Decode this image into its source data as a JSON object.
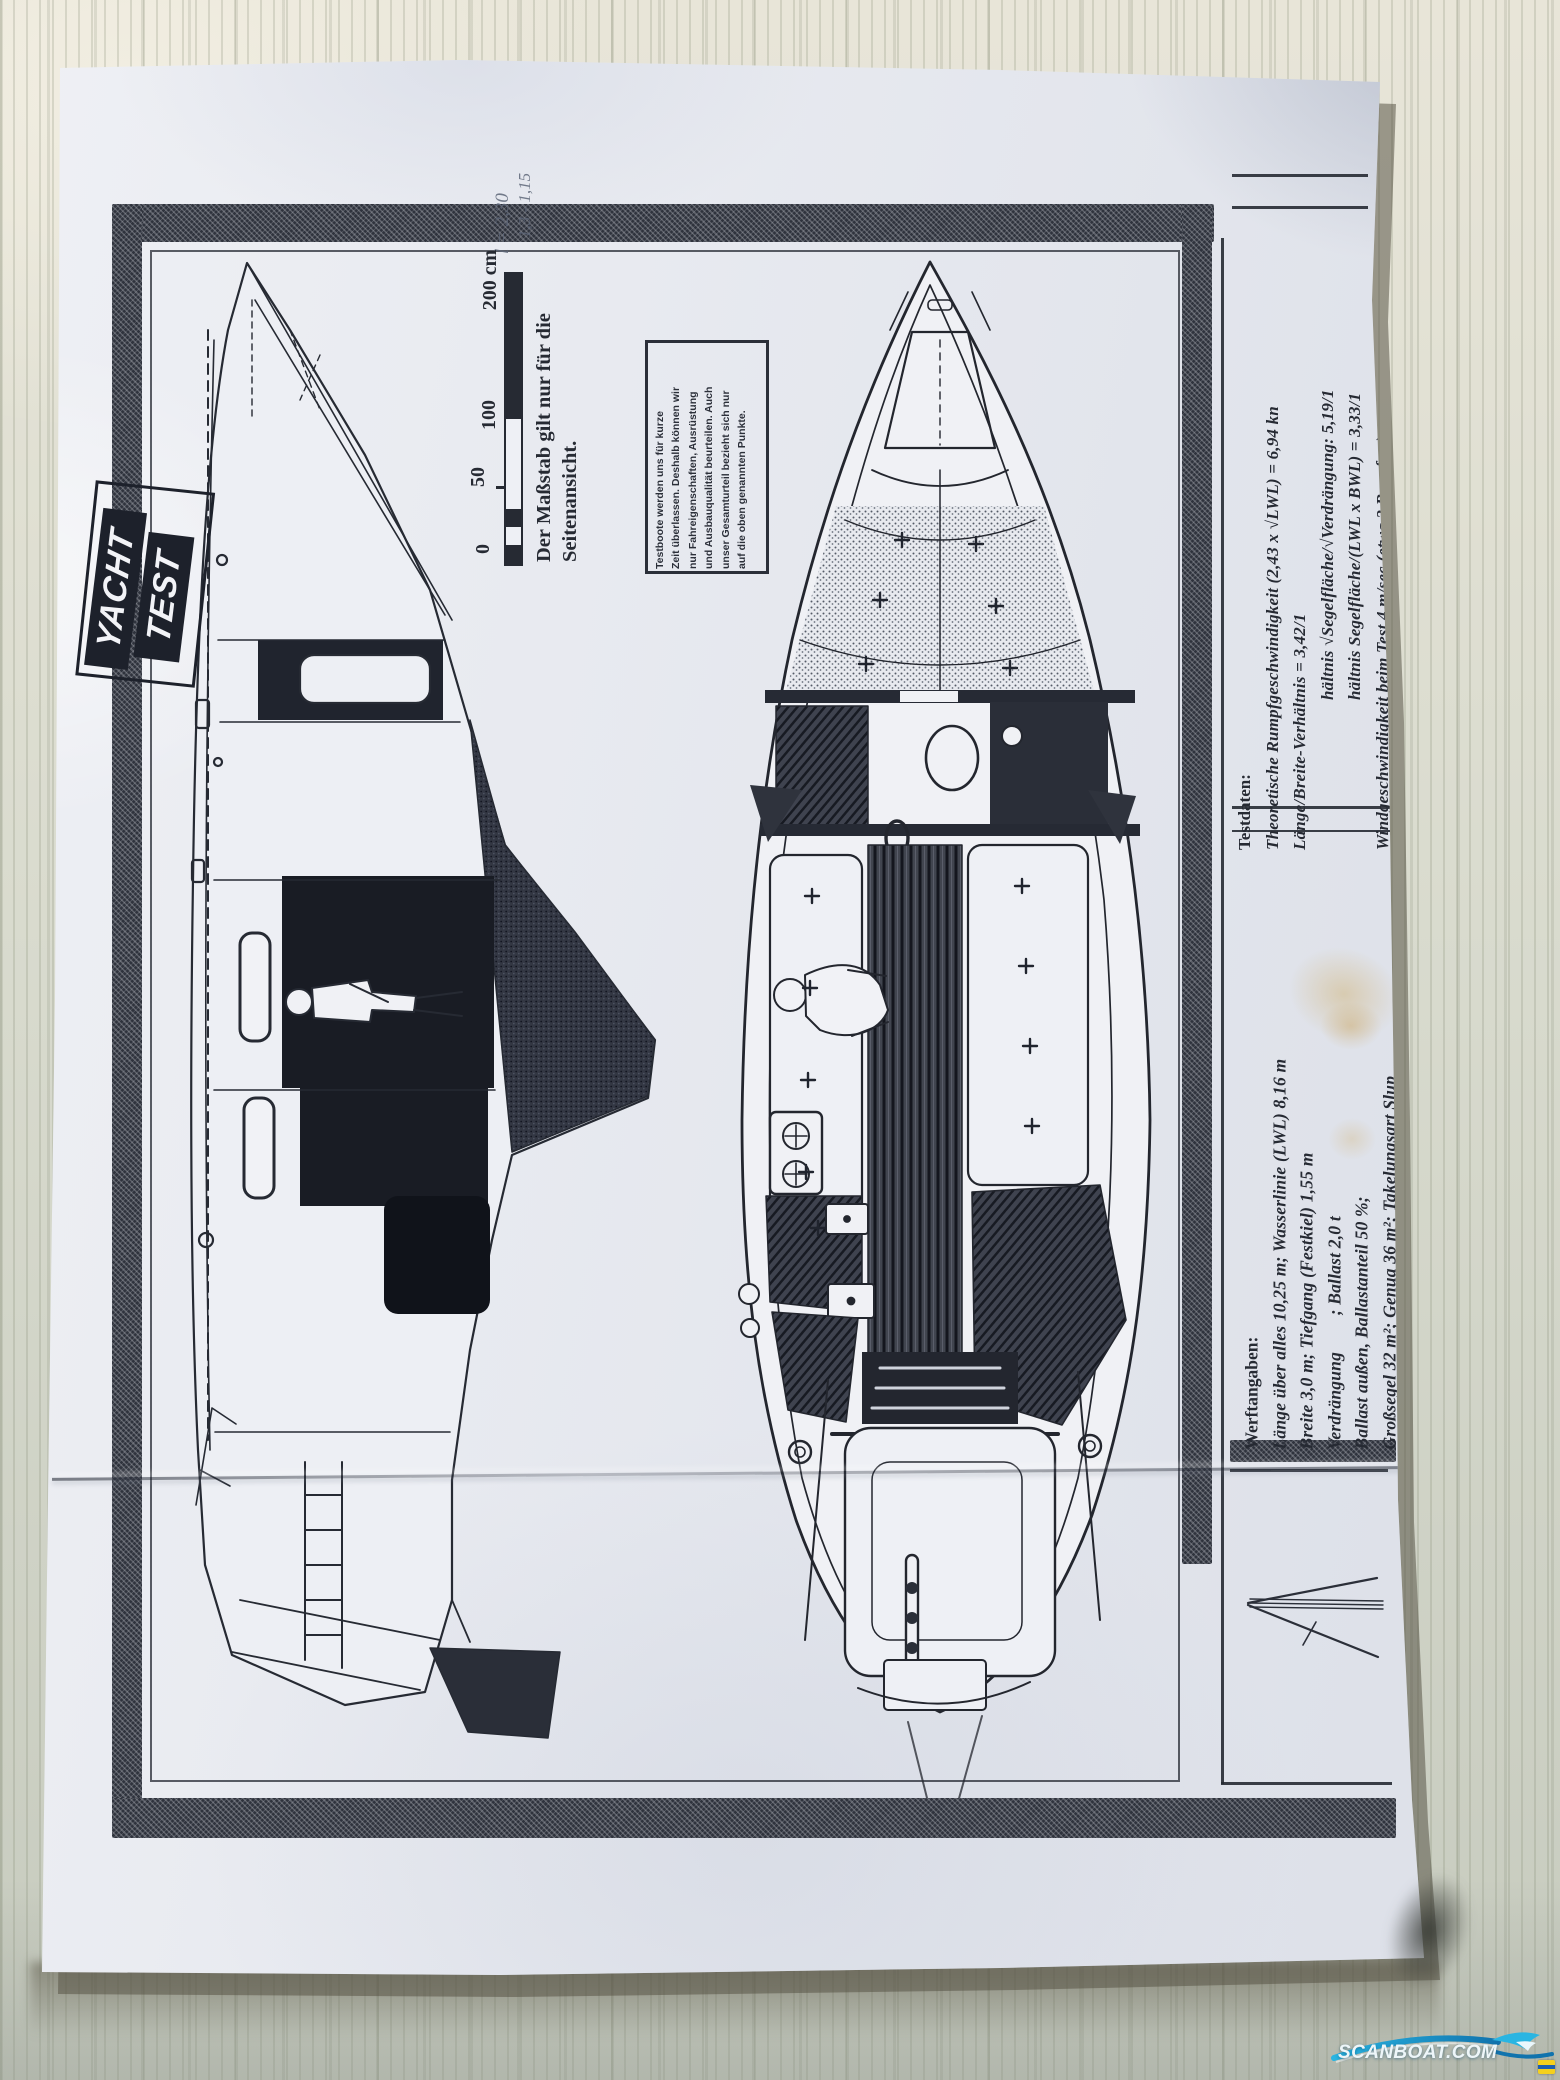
{
  "photo": {
    "subject": "Photocopied yacht test sheet with side-view and deck-plan drawings lying on a light wooden surface"
  },
  "logo": {
    "line1": "YACHT",
    "line2": "TEST"
  },
  "handwriting": {
    "lines": [
      "l = 2,30",
      "1,3 - 1,15"
    ]
  },
  "scale_bar": {
    "unit_labels": [
      "0",
      "50",
      "100",
      "200 cm"
    ],
    "caption_lines": [
      "Der Maßstab gilt nur für die",
      "Seitenansicht."
    ]
  },
  "disclaimer_box": {
    "lines": [
      "Testboote werden uns für kurze",
      "Zeit überlassen. Deshalb können wir",
      "nur Fahreigenschaften, Ausrüstung",
      "und Ausbauqualität beurteilen. Auch",
      "unser Gesamturteil bezieht sich nur",
      "auf die oben genannten Punkte."
    ]
  },
  "testdaten": {
    "heading": "Testdaten:",
    "lines": [
      "Theoretische Rumpfgeschwindigkeit (2,43 x √LWL) = 6,94 kn",
      "Länge/Breite-Verhältnis = 3,42/1",
      "hältnis √Segelfläche/√Verdrängung: 5,19/1",
      "hältnis Segelfläche/(LWL x BWL) = 3,33/1",
      "Windgeschwindigkeit beim Test 4 m/sec (etwa 3 Beaufort)"
    ]
  },
  "werftangaben": {
    "heading": "Werftangaben:",
    "lines": [
      "Länge über alles 10,25 m; Wasserlinie (LWL) 8,16 m",
      "Breite 3,0 m; Tiefgang (Festkiel) 1,55 m",
      "Verdrängung        ; Ballast 2,0 t",
      "Ballast außen, Ballastanteil 50 %;",
      "Großsegel 32 m²; Genua 36 m²; Takelungsart Slup"
    ]
  },
  "watermark": {
    "text": "SCANBOAT.COM"
  },
  "colors": {
    "paper": "#e9ebf1",
    "ink": "#262a33",
    "wood": "#d9dbce",
    "wood_grain": "#9aa184",
    "watermark_cyan": "#2ab5e2",
    "watermark_deep": "#1173ad",
    "stain": "#d1b478",
    "pencil": "#5d6678"
  }
}
